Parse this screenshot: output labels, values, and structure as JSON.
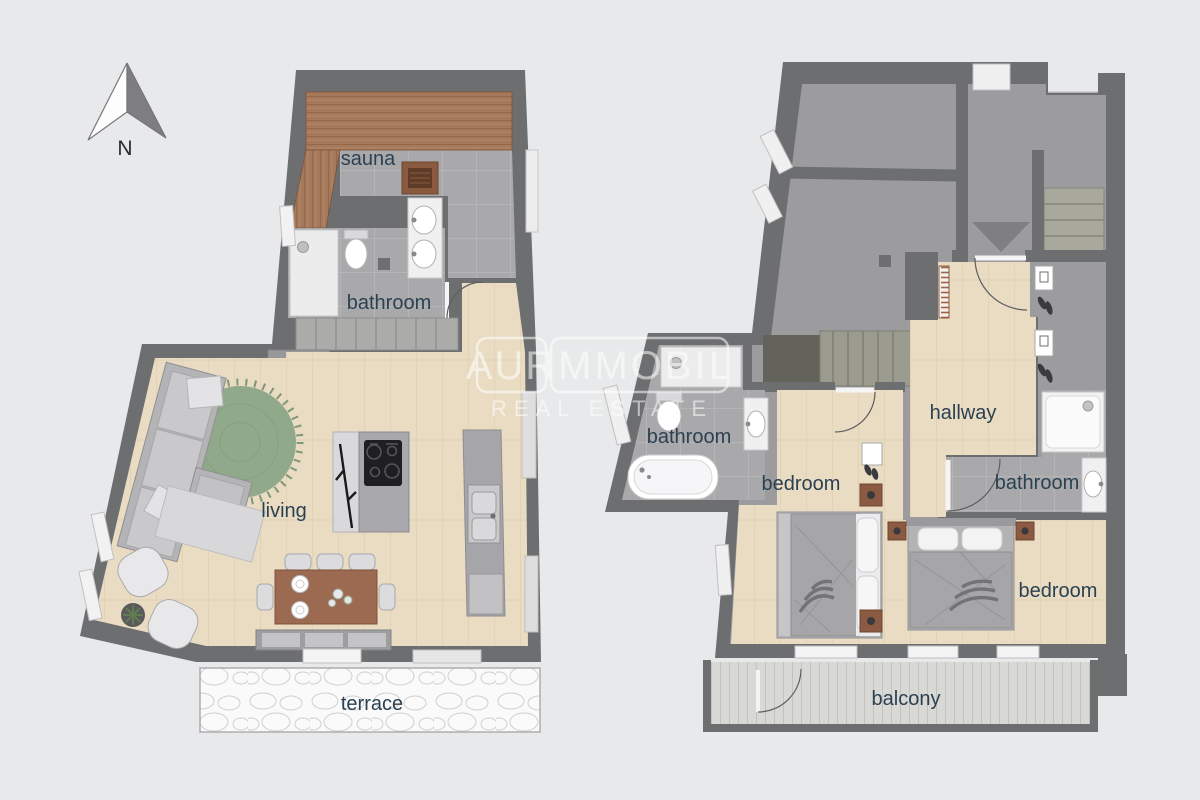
{
  "compass": {
    "label": "N"
  },
  "watermark": {
    "brand_left": "AUR",
    "brand_right": "IMMOBIL",
    "subtitle": "REAL ESTATE"
  },
  "plan_left": {
    "labels": {
      "sauna": "sauna",
      "bathroom": "bathroom",
      "living": "living",
      "terrace": "terrace"
    }
  },
  "plan_right": {
    "labels": {
      "bathroom_left": "bathroom",
      "hallway": "hallway",
      "bedroom_left": "bedroom",
      "bathroom_right": "bathroom",
      "bedroom_right": "bedroom",
      "balcony": "balcony"
    }
  },
  "palette": {
    "background": "#e8e9ea",
    "walls": "#6d6e70",
    "wood_floor": "#e9dcc3",
    "tile_floor": "#a9a9ab",
    "common_floor": "#9c9c9e",
    "sauna_wood": "#a5795b",
    "rug": "#91a98b",
    "deck": "#d8d8d4",
    "terrace": "#fafafa",
    "label_text": "#2b4152",
    "fixtures": "#f2f2f3",
    "furniture": "#b3b3b5",
    "table_wood": "#9c6a50"
  }
}
